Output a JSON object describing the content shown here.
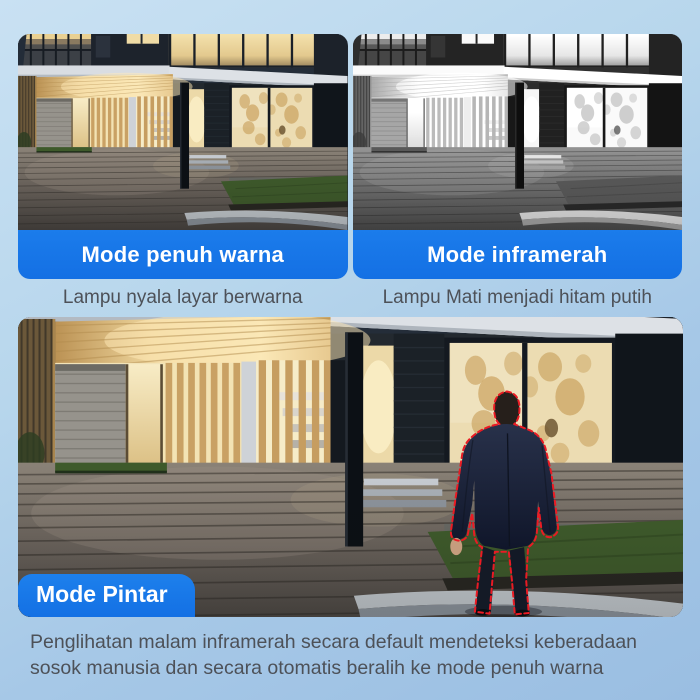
{
  "panels": [
    {
      "banner": "Mode penuh warna",
      "caption": "Lampu nyala layar berwarna"
    },
    {
      "banner": "Mode inframerah",
      "caption": "Lampu Mati menjadi hitam putih"
    }
  ],
  "smart_panel": {
    "banner": "Mode Pintar",
    "caption_line1": "Penglihatan malam inframerah secara default mendeteksi keberadaan",
    "caption_line2": "sosok manusia dan secara otomatis beralih ke mode penuh warna"
  },
  "colors": {
    "accent_blue": "#1677e8",
    "detection_red": "#ea1b24",
    "background_top": "#c9e1f3",
    "background_bottom": "#9abee2",
    "caption_text": "#4d5158"
  }
}
